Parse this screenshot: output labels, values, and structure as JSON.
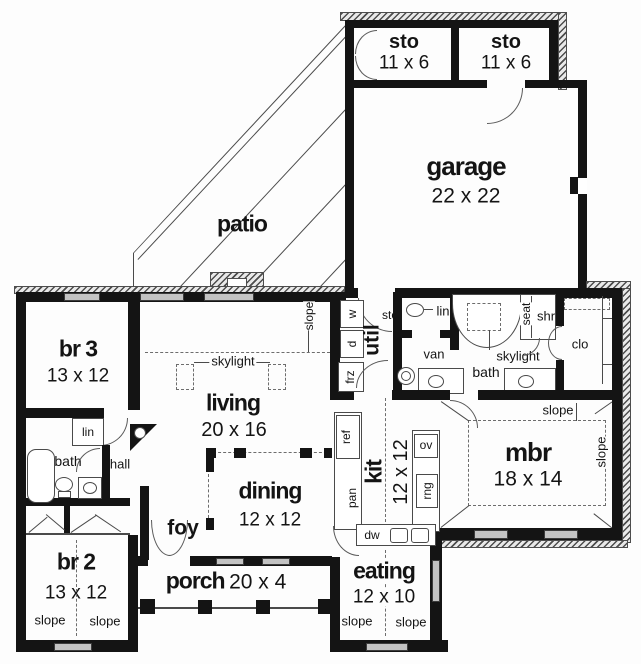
{
  "rooms": {
    "sto": {
      "name": "sto",
      "dims": "11 x 6"
    },
    "garage": {
      "name": "garage",
      "dims": "22 x 22"
    },
    "patio": {
      "name": "patio"
    },
    "br3": {
      "name": "br 3",
      "dims": "13 x 12"
    },
    "living": {
      "name": "living",
      "dims": "20 x 16"
    },
    "util": {
      "name": "util"
    },
    "kit": {
      "name": "kit",
      "dims": "12 x 12"
    },
    "mbr": {
      "name": "mbr",
      "dims": "18 x 14"
    },
    "dining": {
      "name": "dining",
      "dims": "12 x 12"
    },
    "foy": {
      "name": "foy"
    },
    "hall": {
      "name": "hall"
    },
    "porch": {
      "name": "porch",
      "dims": "20 x 4"
    },
    "br2": {
      "name": "br 2",
      "dims": "13 x 12"
    },
    "eating": {
      "name": "eating",
      "dims": "12 x 10"
    },
    "bath": {
      "name": "bath"
    }
  },
  "fixtures": {
    "w": "w",
    "d": "d",
    "frz": "frz",
    "sto": "sto",
    "lin": "lin",
    "van": "van",
    "seat": "seat",
    "shr": "shr",
    "clo": "clo",
    "ref": "ref",
    "pan": "pan",
    "ov": "ov",
    "rng": "rng",
    "dw": "dw"
  },
  "ceiling": {
    "skylight": "skylight",
    "slope": "slope"
  },
  "colors": {
    "wall": "#141414",
    "window": "#c3c3c3",
    "paper": "#fdfdfd"
  }
}
